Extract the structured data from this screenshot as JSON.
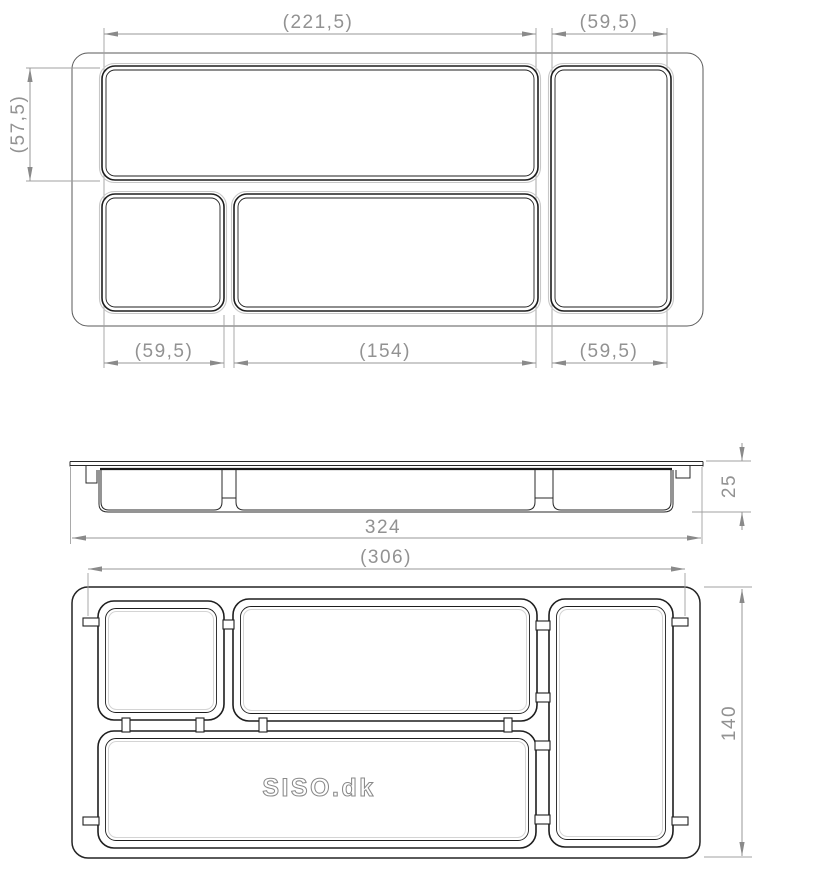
{
  "views": {
    "top": {
      "dim_width_main": "(221,5)",
      "dim_width_right": "(59,5)",
      "dim_height_left": "(57,5)",
      "dim_width_small": "(59,5)",
      "dim_width_long": "(154)",
      "dim_width_right_bottom": "(59,5)"
    },
    "side": {
      "dim_overall_width": "324",
      "dim_height": "25"
    },
    "bottom": {
      "dim_width_ref": "(306)",
      "dim_depth": "140",
      "brand_text": "SISO.dk"
    }
  },
  "colors": {
    "part_line": "#1e1e1e",
    "dimension_line": "#979797",
    "dimension_text": "#929292",
    "background": "#ffffff"
  }
}
